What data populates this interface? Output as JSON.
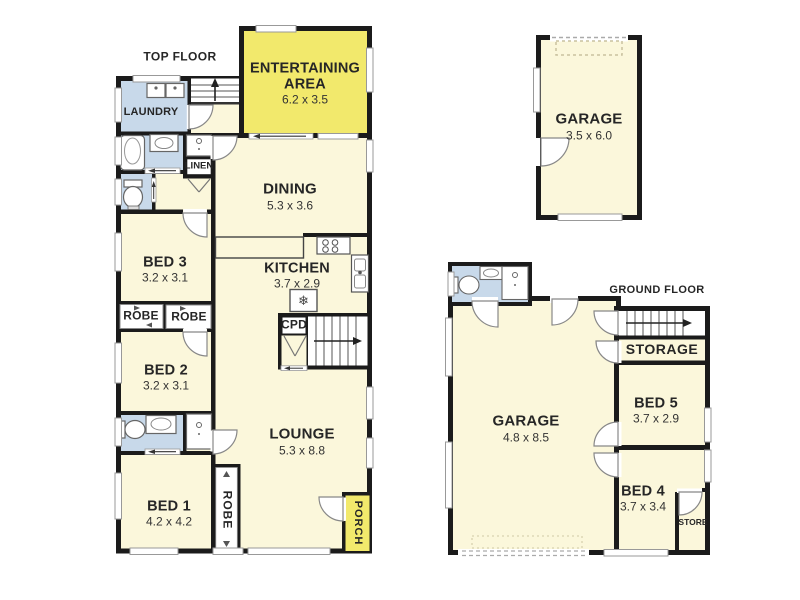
{
  "titles": {
    "top_floor": "TOP FLOOR",
    "ground_floor": "GROUND FLOOR"
  },
  "top_floor": {
    "entertaining": {
      "name": "ENTERTAINING AREA",
      "dims": "6.2 x 3.5"
    },
    "laundry": {
      "name": "LAUNDRY"
    },
    "linen": {
      "name": "LINEN"
    },
    "dining": {
      "name": "DINING",
      "dims": "5.3 x 3.6"
    },
    "bed3": {
      "name": "BED 3",
      "dims": "3.2 x 3.1"
    },
    "kitchen": {
      "name": "KITCHEN",
      "dims": "3.7 x 2.9"
    },
    "robe_left": {
      "name": "ROBE"
    },
    "robe_right": {
      "name": "ROBE"
    },
    "cpd": {
      "name": "CPD"
    },
    "bed2": {
      "name": "BED 2",
      "dims": "3.2 x 3.1"
    },
    "lounge": {
      "name": "LOUNGE",
      "dims": "5.3 x 8.8"
    },
    "bed1": {
      "name": "BED 1",
      "dims": "4.2 x 4.2"
    },
    "robe_bed1": {
      "name": "ROBE"
    },
    "porch": {
      "name": "PORCH"
    }
  },
  "detached_garage": {
    "name": "GARAGE",
    "dims": "3.5 x 6.0"
  },
  "ground_floor": {
    "garage": {
      "name": "GARAGE",
      "dims": "4.8 x 8.5"
    },
    "storage": {
      "name": "STORAGE"
    },
    "bed5": {
      "name": "BED 5",
      "dims": "3.7 x 2.9"
    },
    "bed4": {
      "name": "BED 4",
      "dims": "3.7 x 3.4"
    },
    "store": {
      "name": "STORE"
    }
  },
  "icons": {
    "fridge": "❄"
  },
  "colors": {
    "wall": "#1b1b1b",
    "room": "#FBF7DB",
    "wet_area": "#C8D9EA",
    "highlight": "#F2E96C"
  }
}
